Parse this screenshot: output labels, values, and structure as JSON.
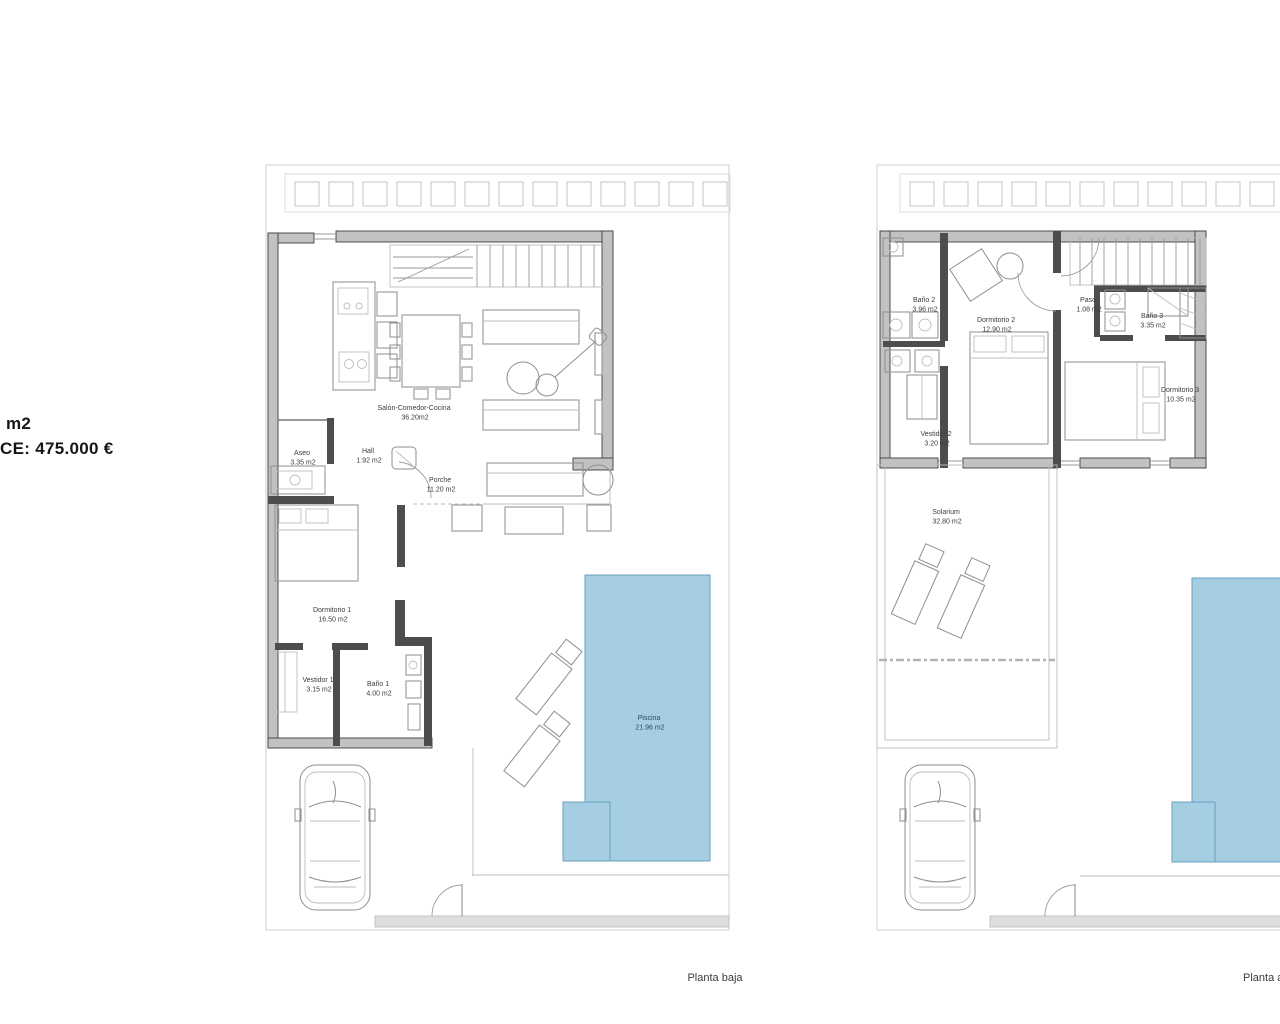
{
  "price": {
    "line1": "m2",
    "line2": "CE: 475.000 €"
  },
  "captions": {
    "ground": "Planta baja",
    "upper": "Planta alta"
  },
  "colors": {
    "pool_fill": "#a5cee2",
    "pool_stroke": "#68a0bd",
    "wall_fill": "#c2c2c2",
    "wall_stroke": "#3f3f3f",
    "plot_line": "#cfcfcf",
    "label_text": "#3c3c3c",
    "pool_label_text": "#27496b"
  },
  "ground": {
    "rooms": {
      "salon": {
        "name": "Salón-Comedor-Cocina",
        "area": "36.20m2"
      },
      "aseo": {
        "name": "Aseo",
        "area": "3.35 m2"
      },
      "hall": {
        "name": "Hall",
        "area": "1.92 m2"
      },
      "porche": {
        "name": "Porche",
        "area": "11.20 m2"
      },
      "dormitorio1": {
        "name": "Dormitorio 1",
        "area": "16.50 m2"
      },
      "vestidor1": {
        "name": "Vestidor 1",
        "area": "3.15 m2"
      },
      "bano1": {
        "name": "Baño 1",
        "area": "4.00 m2"
      },
      "piscina": {
        "name": "Piscina",
        "area": "21.96 m2"
      }
    }
  },
  "upper": {
    "rooms": {
      "bano2": {
        "name": "Baño 2",
        "area": "3.96 m2"
      },
      "dormitorio2": {
        "name": "Dormitorio 2",
        "area": "12.90 m2"
      },
      "paso": {
        "name": "Paso",
        "area": "1.08 m2"
      },
      "bano3": {
        "name": "Baño 3",
        "area": "3.35 m2"
      },
      "dormitorio3": {
        "name": "Dormitorio 3",
        "area": "10.35 m2"
      },
      "vestidor2": {
        "name": "Vestidor 2",
        "area": "3.20 m2"
      },
      "solarium": {
        "name": "Solarium",
        "area": "32.80 m2"
      }
    }
  }
}
